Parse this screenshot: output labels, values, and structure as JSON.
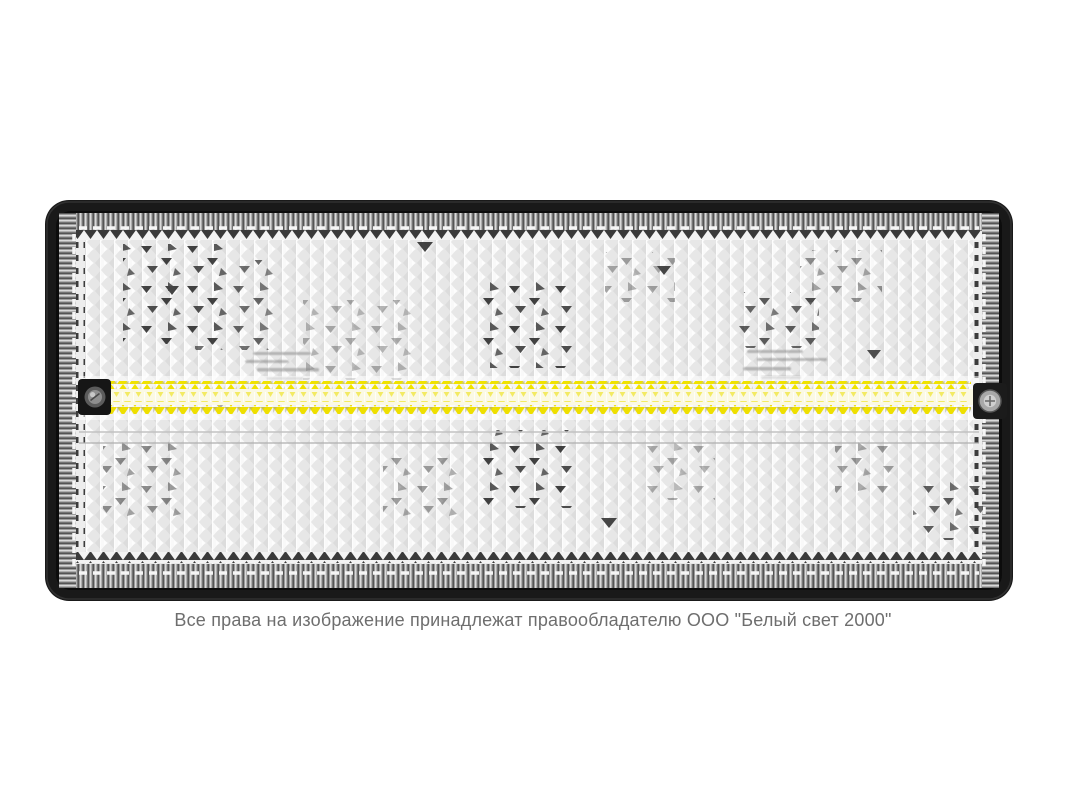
{
  "caption": {
    "text": "Все права на изображение принадлежат правообладателю ООО \"Белый свет 2000\""
  },
  "product": {
    "subject_name": "led-bulkhead-luminaire",
    "led_rows": 2,
    "screws": 2,
    "colors": {
      "background": "#ffffff",
      "frame": "#191919",
      "rib_band": "#9b9b9b",
      "diffuser": "#e7e7e7",
      "led_yellow": "#f2e400",
      "caption_text": "#6e6e6e"
    }
  }
}
